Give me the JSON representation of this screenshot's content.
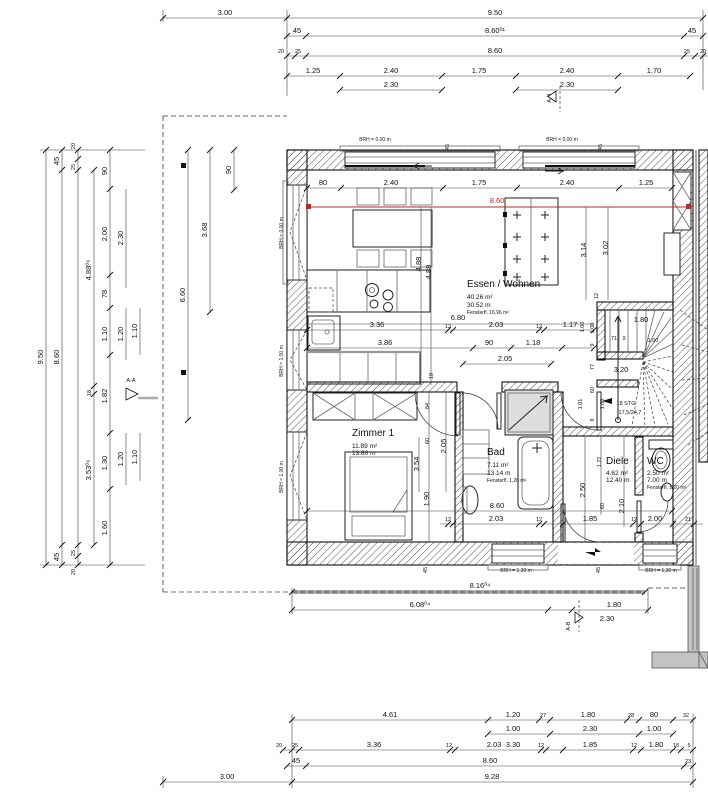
{
  "drawing": {
    "rooms": {
      "essen_wohnen": {
        "name": "Essen / Wohnen",
        "area": "40.26 m²",
        "perimeter": "30.52 m",
        "fenster": "Fensterfl. 16,96 m²"
      },
      "zimmer1": {
        "name": "Zimmer 1",
        "area": "11.89 m²",
        "perimeter": "13.80 m"
      },
      "bad": {
        "name": "Bad",
        "area": "7.11 m²",
        "perimeter": "13.14 m",
        "fenster": "Fensterfl. 1,20 m²"
      },
      "diele": {
        "name": "Diele",
        "area": "4.62 m²",
        "perimeter": "12.40 m"
      },
      "wc": {
        "name": "WC",
        "area": "2.50 m²",
        "perimeter": "7.00 m",
        "fenster": "Fensterfl. 1,20 m²"
      }
    },
    "stair": {
      "steps": "18 STG",
      "ratio": "17,5/24,7"
    },
    "markers": {
      "ab": "A-B",
      "aa": "A-A"
    },
    "red_dim": "8.60",
    "brh": {
      "b000": "BRH = 0,00 m",
      "b100": "BRH = 1,00 m",
      "b130": "BRH = 1,30 m"
    },
    "dims": {
      "top1": [
        "3.00",
        "9.50"
      ],
      "top2": [
        "45",
        "8.60⁰¹",
        "45"
      ],
      "top3": [
        "20",
        "25",
        "8.60",
        "25",
        "20"
      ],
      "top4": [
        "1.25",
        "2.40",
        "1.75",
        "2.40",
        "1.70"
      ],
      "top5": [
        "2.30",
        "2.30"
      ],
      "inner_top": [
        "80",
        "2.40",
        "1.75",
        "2.40",
        "1.25"
      ],
      "left1": [
        "9.50"
      ],
      "left2": [
        "45",
        "8.60",
        "45"
      ],
      "left3": [
        "20",
        "25",
        "25",
        "20"
      ],
      "left4": [
        "4.88⁰⁶",
        "18",
        "3.53⁰⁶"
      ],
      "left5": [
        "90",
        "2.00",
        "78",
        "1.10",
        "1.82",
        "1.30",
        "1.60"
      ],
      "left6": [
        "2.30",
        "1.20",
        "1.20"
      ],
      "left7": [
        "1.10",
        "1.10"
      ],
      "site": [
        "6.60",
        "3.68",
        "90"
      ],
      "living": [
        "3.14",
        "3.02",
        "12",
        "4.88",
        "4.88"
      ],
      "kitchen1": [
        "6.80"
      ],
      "kitchen2": [
        "3.36",
        "12",
        "2.03",
        "12",
        "1.17"
      ],
      "kitchen3": [
        "3.86",
        "90",
        "1.18"
      ],
      "kitchen4": [
        "2.05"
      ],
      "staircol": [
        "1.00",
        "1.00",
        "9",
        "77",
        "60",
        "9",
        "1.01",
        "1.00"
      ],
      "stairdims": [
        "1.80",
        "71",
        "9",
        "1.00",
        "3.20"
      ],
      "zimmer": [
        "84",
        "60",
        "3.54",
        "1.90",
        "18",
        "2.05"
      ],
      "diele": [
        "1.22",
        "2.50",
        "60",
        "2.10"
      ],
      "inner_bottom": [
        "8.60",
        "12",
        "2.03",
        "12",
        "1.85",
        "12",
        "2.00",
        "21"
      ],
      "jamb": "45",
      "mid": [
        "8.16⁰⁴",
        "6.08⁰⁴",
        "1.80",
        "2.30"
      ],
      "bot1": [
        "4.61",
        "1.20",
        "27",
        "1.80",
        "28",
        "80",
        "32"
      ],
      "bot2": [
        "1.00",
        "2.30",
        "1.00"
      ],
      "bot3": [
        "20",
        "25",
        "3.36",
        "12",
        "2.03",
        "3.30",
        "12",
        "1.85",
        "12",
        "1.80",
        "18",
        "5"
      ],
      "bot4": [
        "45",
        "8.60",
        "23"
      ],
      "bot5": [
        "3.00",
        "9.28"
      ]
    }
  }
}
